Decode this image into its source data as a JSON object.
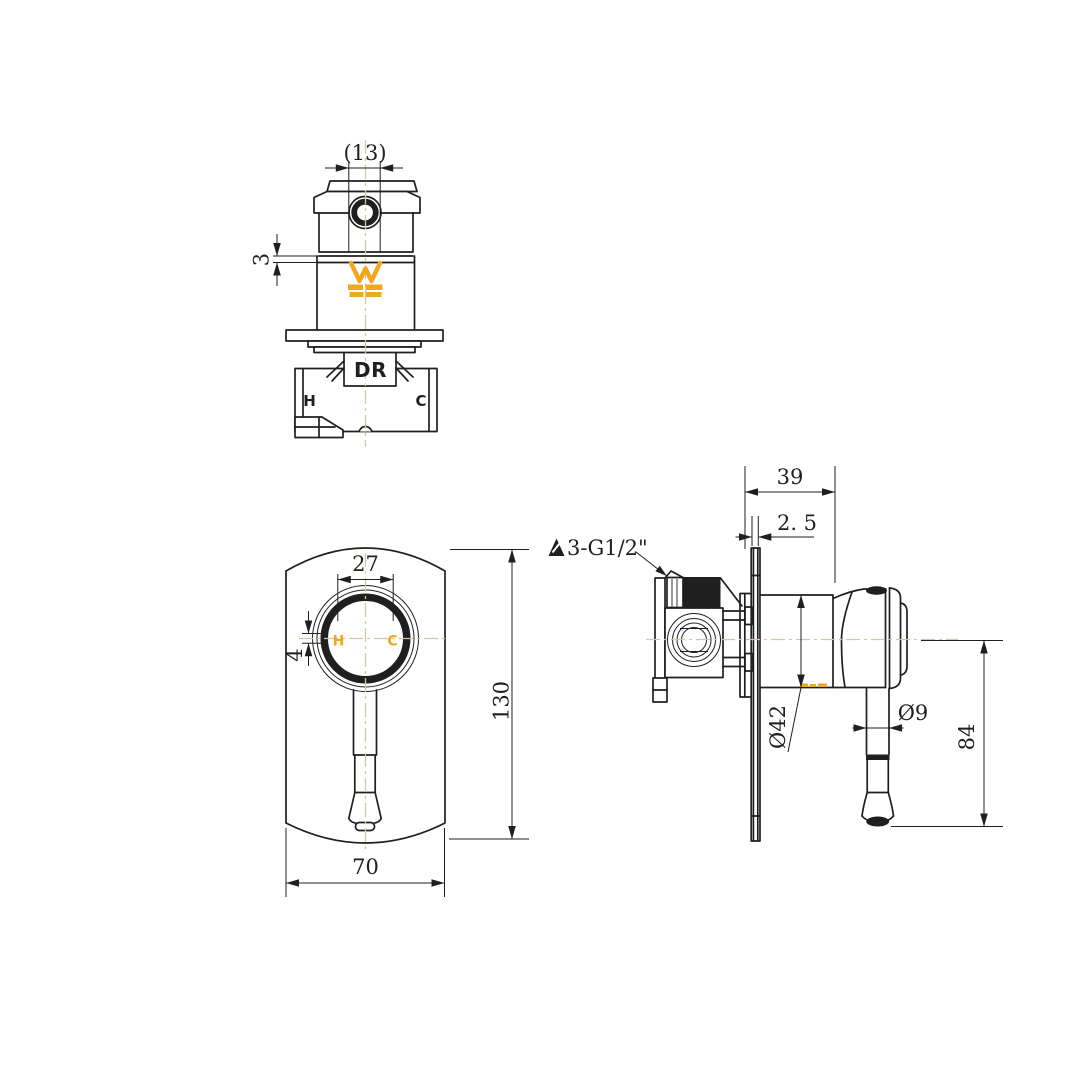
{
  "drawing": {
    "kind": "technical-drawing",
    "colors": {
      "line": "#1f1f1f",
      "accent_orange": "#f2a71f",
      "centerline_tan": "#d4c8a4",
      "background": "#ffffff"
    },
    "views": {
      "top": {
        "dim_hole": "(13)",
        "dim_groove": "3",
        "cartridge_label": "DR",
        "hot_label": "H",
        "cold_label": "C"
      },
      "front": {
        "dim_ring": "27",
        "dim_offset": "4",
        "dim_height": "130",
        "dim_width": "70",
        "hot_label": "H",
        "cold_label": "C"
      },
      "side": {
        "dim_depth": "39",
        "dim_plate": "2. 5",
        "thread_note": "3-G1/2\"",
        "dim_escutcheon": "Ø42",
        "dim_handle_dia": "Ø9",
        "dim_handle_len": "84"
      }
    }
  }
}
